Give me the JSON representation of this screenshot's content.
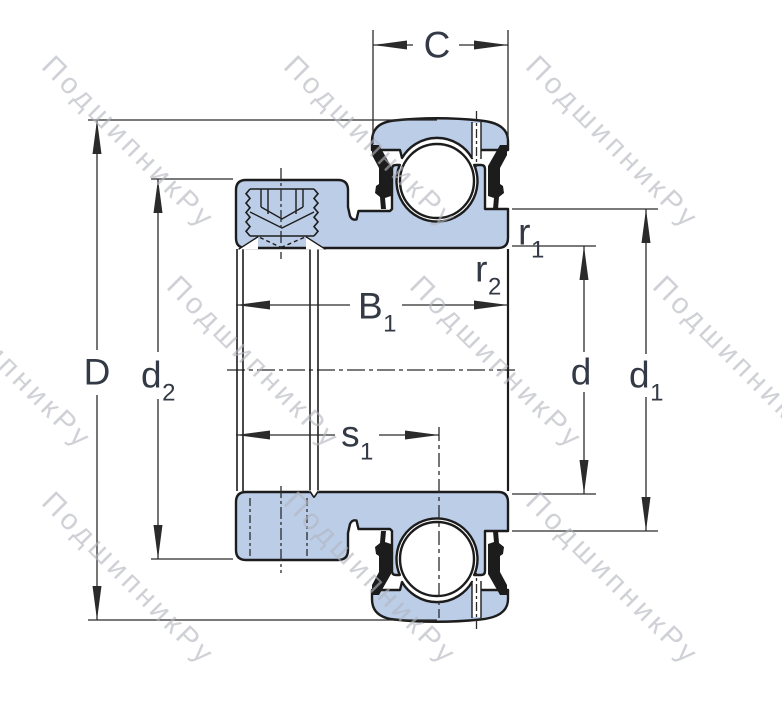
{
  "labels": {
    "C": "C",
    "D": "D",
    "d": "d",
    "d1": {
      "base": "d",
      "sub": "1"
    },
    "d2": {
      "base": "d",
      "sub": "2"
    },
    "B1": {
      "base": "B",
      "sub": "1"
    },
    "s1": {
      "base": "s",
      "sub": "1"
    },
    "r1": {
      "base": "r",
      "sub": "1"
    },
    "r2": {
      "base": "r",
      "sub": "2"
    }
  },
  "watermark": {
    "text": "ПодшипникРу"
  },
  "colors": {
    "c-fill": "#bccde8",
    "c-line": "#1c1c1c",
    "c-dim": "#2b2b2b",
    "c-label": "#333a45",
    "c-wm": "#b2b6bd"
  }
}
